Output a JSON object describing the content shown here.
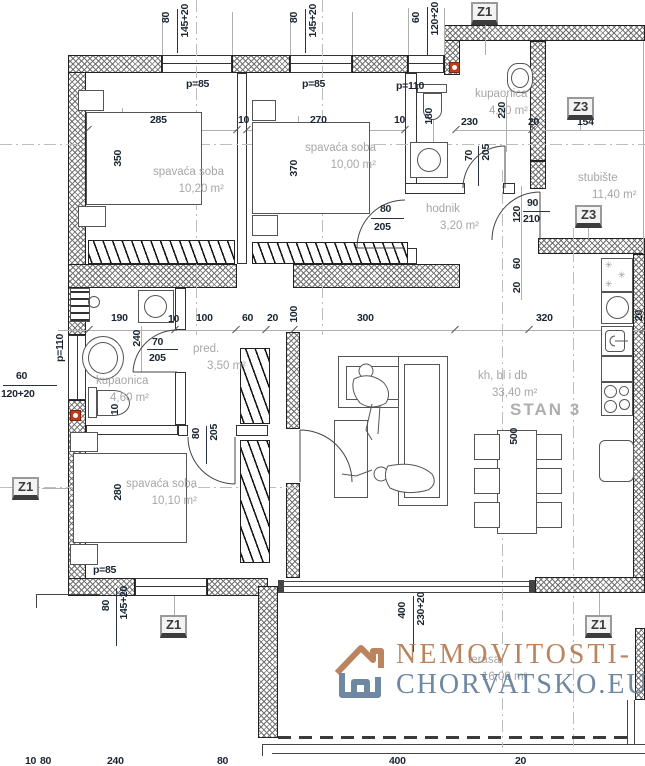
{
  "plan": {
    "stan_label": "STAN 3",
    "watermark": {
      "line1": "NEMOVITOSTI-",
      "line2": "CHORVATSKO.EU"
    },
    "rooms": {
      "bedroom1": {
        "name": "spavaća soba",
        "area": "10,20 m²"
      },
      "bedroom2": {
        "name": "spavaća soba",
        "area": "10,00 m²"
      },
      "bath_top": {
        "name": "kupaonica",
        "area": "4,70 m²"
      },
      "stairs": {
        "name": "stubište",
        "area": "11,40 m²"
      },
      "hall": {
        "name": "hodnik",
        "area": "3,20 m²"
      },
      "bath_left": {
        "name": "kupaonica",
        "area": "4,60 m²"
      },
      "entry": {
        "name": "pred.",
        "area": "3,50 m²"
      },
      "bedroom3": {
        "name": "spavaća soba",
        "area": "10,10 m²"
      },
      "living": {
        "name": "kh, bl i db",
        "area": "33,40 m²"
      },
      "terrace": {
        "name": "terasa",
        "area": "16,00 m²"
      }
    },
    "markers": {
      "z1": "Z1",
      "z3": "Z3"
    },
    "dims": {
      "v10": "10",
      "v20": "20",
      "v60": "60",
      "v70": "70",
      "v80": "80",
      "v90": "90",
      "v100": "100",
      "v120": "120",
      "v154": "154",
      "v180": "180",
      "v190": "190",
      "v205": "205",
      "v210": "210",
      "v220": "220",
      "v230": "230",
      "v240": "240",
      "v270": "270",
      "v280": "280",
      "v285": "285",
      "v300": "300",
      "v320": "320",
      "v350": "350",
      "v370": "370",
      "v400": "400",
      "v500": "500",
      "w145": "145+20",
      "w120": "120+20",
      "w230": "230+20",
      "p85": "p=85",
      "p110": "p=110"
    }
  }
}
